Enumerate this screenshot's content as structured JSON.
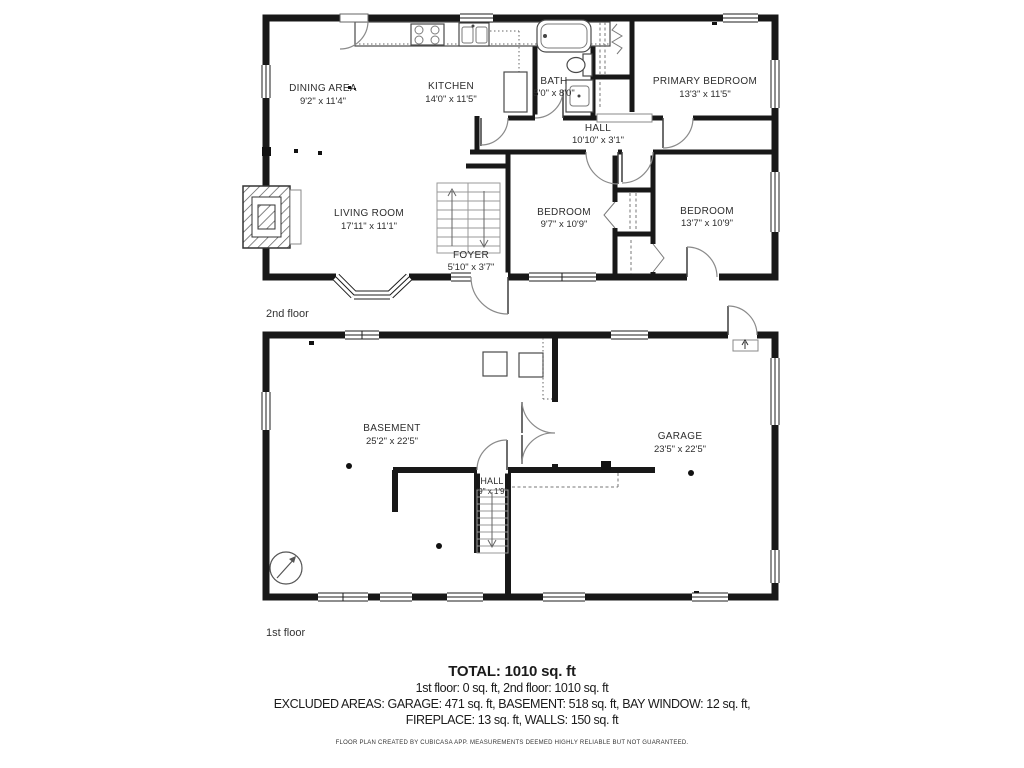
{
  "floors": [
    {
      "label": "2nd floor",
      "rooms": [
        {
          "name": "DINING AREA",
          "dims": "9'2\" x 11'4\""
        },
        {
          "name": "KITCHEN",
          "dims": "14'0\" x 11'5\""
        },
        {
          "name": "BATH",
          "dims": "5'0\" x 8'0\""
        },
        {
          "name": "PRIMARY BEDROOM",
          "dims": "13'3\" x 11'5\""
        },
        {
          "name": "HALL",
          "dims": "10'10\" x 3'1\""
        },
        {
          "name": "LIVING ROOM",
          "dims": "17'11\" x 11'1\""
        },
        {
          "name": "FOYER",
          "dims": "5'10\" x 3'7\""
        },
        {
          "name": "BEDROOM",
          "dims": "9'7\" x 10'9\""
        },
        {
          "name": "BEDROOM",
          "dims": "13'7\" x 10'9\""
        }
      ]
    },
    {
      "label": "1st floor",
      "rooms": [
        {
          "name": "BASEMENT",
          "dims": "25'2\" x 22'5\""
        },
        {
          "name": "HALL",
          "dims": "'9\" x 1'9\""
        },
        {
          "name": "GARAGE",
          "dims": "23'5\" x 22'5\""
        }
      ]
    }
  ],
  "summary": {
    "total": "TOTAL: 1010 sq. ft",
    "floor_breakdown": "1st floor: 0 sq. ft, 2nd floor: 1010 sq. ft",
    "excluded_line1": "EXCLUDED AREAS: GARAGE: 471 sq. ft, BASEMENT: 518 sq. ft, BAY WINDOW: 12 sq. ft,",
    "excluded_line2": "FIREPLACE: 13 sq. ft, WALLS: 150 sq. ft",
    "disclaimer": "FLOOR PLAN CREATED BY CUBICASA APP. MEASUREMENTS DEEMED HIGHLY RELIABLE BUT NOT GUARANTEED."
  }
}
